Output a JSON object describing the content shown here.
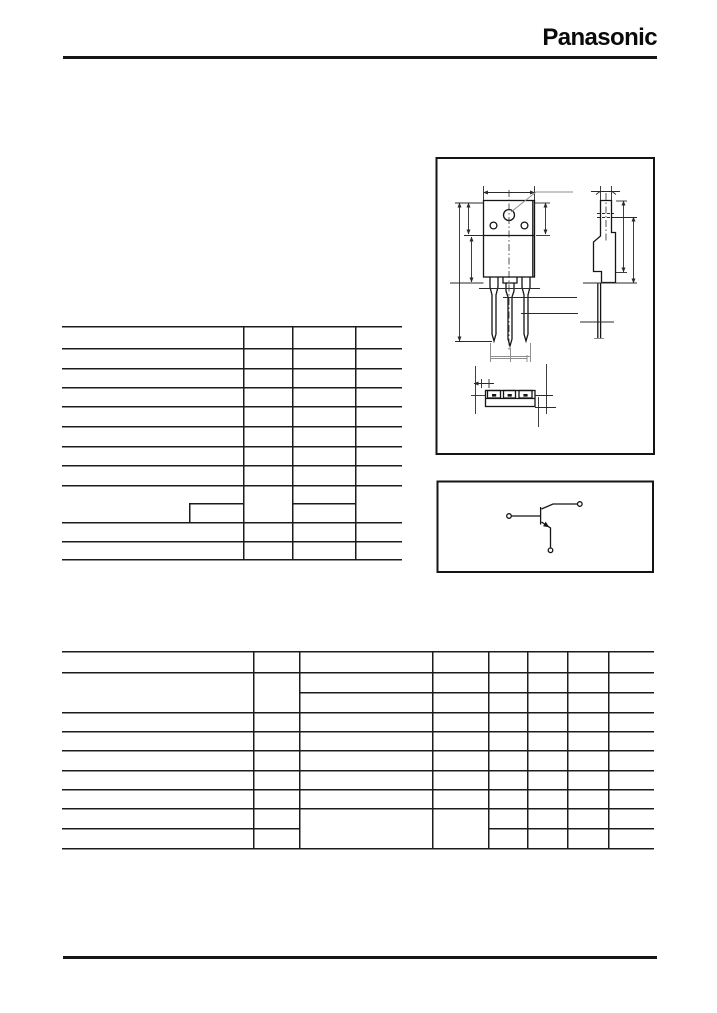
{
  "brand": {
    "name": "Panasonic"
  },
  "colors": {
    "ink": "#161616",
    "table_line": "#1c1c1c",
    "dim_gray": "#8f8f8f",
    "background": "#ffffff"
  },
  "figures": {
    "package_drawing": "package-outline-three-views",
    "schematic": "npn-transistor-internal-connection"
  },
  "tables": {
    "ratings_table": {
      "row_bands": 12,
      "columns": 4,
      "cells_text": ""
    },
    "characteristics_table": {
      "row_bands": 10,
      "columns": 8,
      "cells_text": ""
    }
  }
}
